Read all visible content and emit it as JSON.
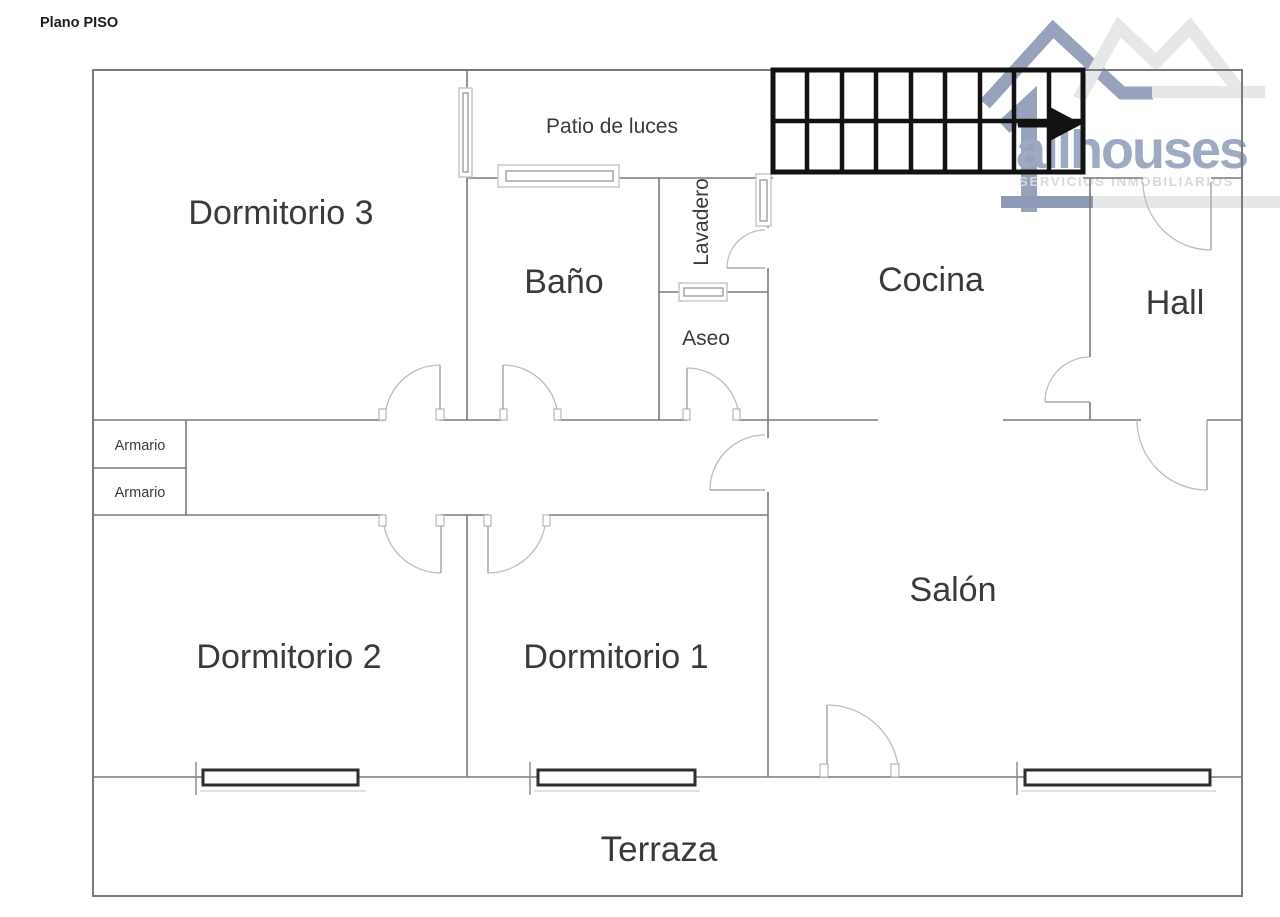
{
  "page_title": "Plano PISO",
  "logo": {
    "brand": "allhouses",
    "tagline": "SERVICIOS INMOBILIARIOS",
    "brand_color": "#9ea9c2",
    "tagline_color": "#d9d9d9",
    "roof_dark_color": "#98a2bc",
    "roof_light_color": "#e6e7e9",
    "bar_dark_color": "#8e9ab6",
    "bar_light_color": "#e6e7e9"
  },
  "rooms": [
    {
      "id": "dormitorio-3",
      "label": "Dormitorio 3"
    },
    {
      "id": "bano",
      "label": "Baño"
    },
    {
      "id": "lavadero",
      "label": "Lavadero"
    },
    {
      "id": "aseo",
      "label": "Aseo"
    },
    {
      "id": "cocina",
      "label": "Cocina"
    },
    {
      "id": "hall",
      "label": "Hall"
    },
    {
      "id": "dormitorio-2",
      "label": "Dormitorio 2"
    },
    {
      "id": "dormitorio-1",
      "label": "Dormitorio 1"
    },
    {
      "id": "salon",
      "label": "Salón"
    },
    {
      "id": "terraza",
      "label": "Terraza"
    },
    {
      "id": "patio-de-luces",
      "label": "Patio de luces"
    }
  ],
  "closets": [
    {
      "label": "Armario"
    },
    {
      "label": "Armario"
    }
  ],
  "stairs": {
    "rows": 2,
    "columns": 9,
    "arrow_direction": "right"
  },
  "colors": {
    "wall": "#7a7a7a",
    "door": "#bdbdbd",
    "door_leaf": "#a8a8a8",
    "window_light_frame": "#c4c4c4",
    "window_inner_frame": "#8f8f8f",
    "window_dark_frame": "#2e2e2e",
    "stairs": "#121212",
    "label": "#3a3a3a",
    "title": "#1c1c1c"
  }
}
